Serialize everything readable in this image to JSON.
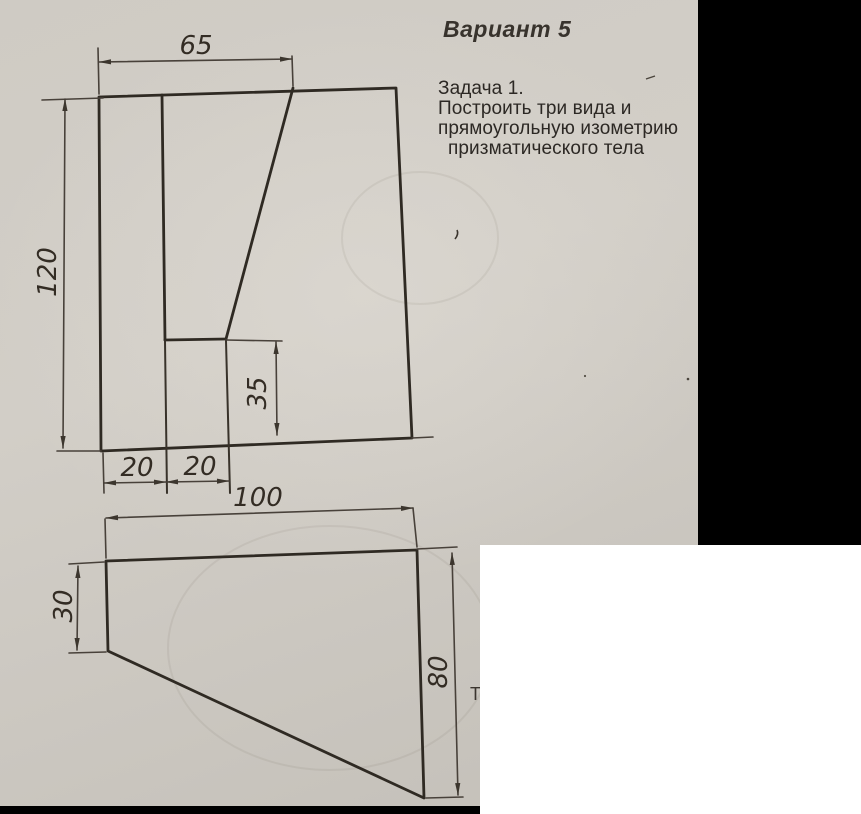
{
  "header": {
    "title": "Вариант 5"
  },
  "task": {
    "lines": [
      "Задача 1.",
      "Построить  три вида и",
      "прямоугольную изометрию",
      "призматического тела"
    ]
  },
  "front_view": {
    "dims": {
      "width_top": "65",
      "height_left": "120",
      "step_height": "35",
      "offset_1": "20",
      "offset_2": "20"
    }
  },
  "plan_view": {
    "dims": {
      "width_top": "100",
      "height_left": "30",
      "height_right": "80"
    }
  },
  "artifacts": {
    "cropped_letter": "Т"
  },
  "colors": {
    "paper": "#cdc9c2",
    "ink": "#2f2a23",
    "dim_ink": "#48413a",
    "mask_black": "#000000",
    "mask_white": "#ffffff"
  }
}
